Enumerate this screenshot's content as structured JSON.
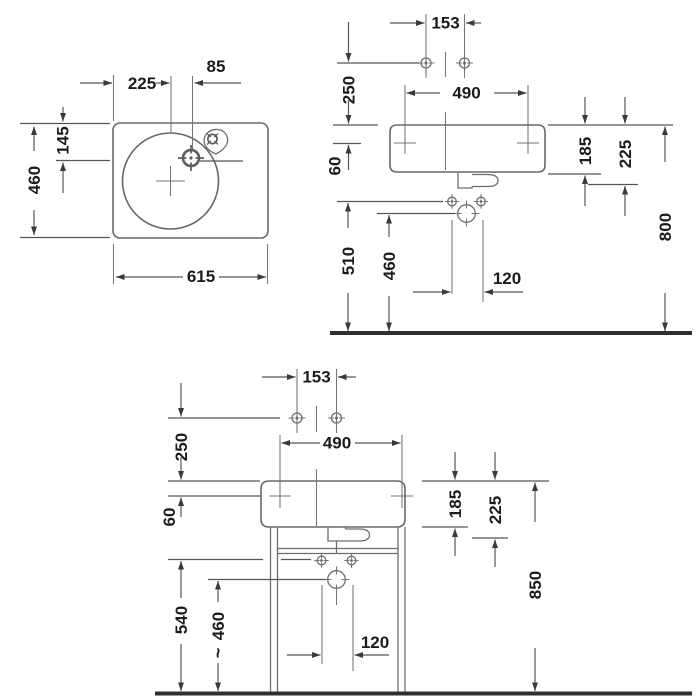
{
  "drawing": {
    "description": "Washbasin technical dimension drawing, three views",
    "plan": {
      "width": "615",
      "depth": "460",
      "bowl_center_from_left": "225",
      "faucet_from_bowl_center": "85",
      "faucet_from_back": "145"
    },
    "wall": {
      "hole_spacing": "153",
      "above_rim": "250",
      "fixing_span": "490",
      "fixing_below_rim": "60",
      "body_height": "185",
      "apron_height": "225",
      "screws_height": "510",
      "drain_height": "460",
      "screw_spacing": "120",
      "rim_height": "800"
    },
    "console": {
      "hole_spacing": "153",
      "above_rim": "250",
      "fixing_span": "490",
      "fixing_below_rim": "60",
      "body_height": "185",
      "apron_height": "225",
      "screws_height": "540",
      "drain_height": "460",
      "approx_sign": "~",
      "screw_spacing": "120",
      "rim_height": "850"
    }
  }
}
